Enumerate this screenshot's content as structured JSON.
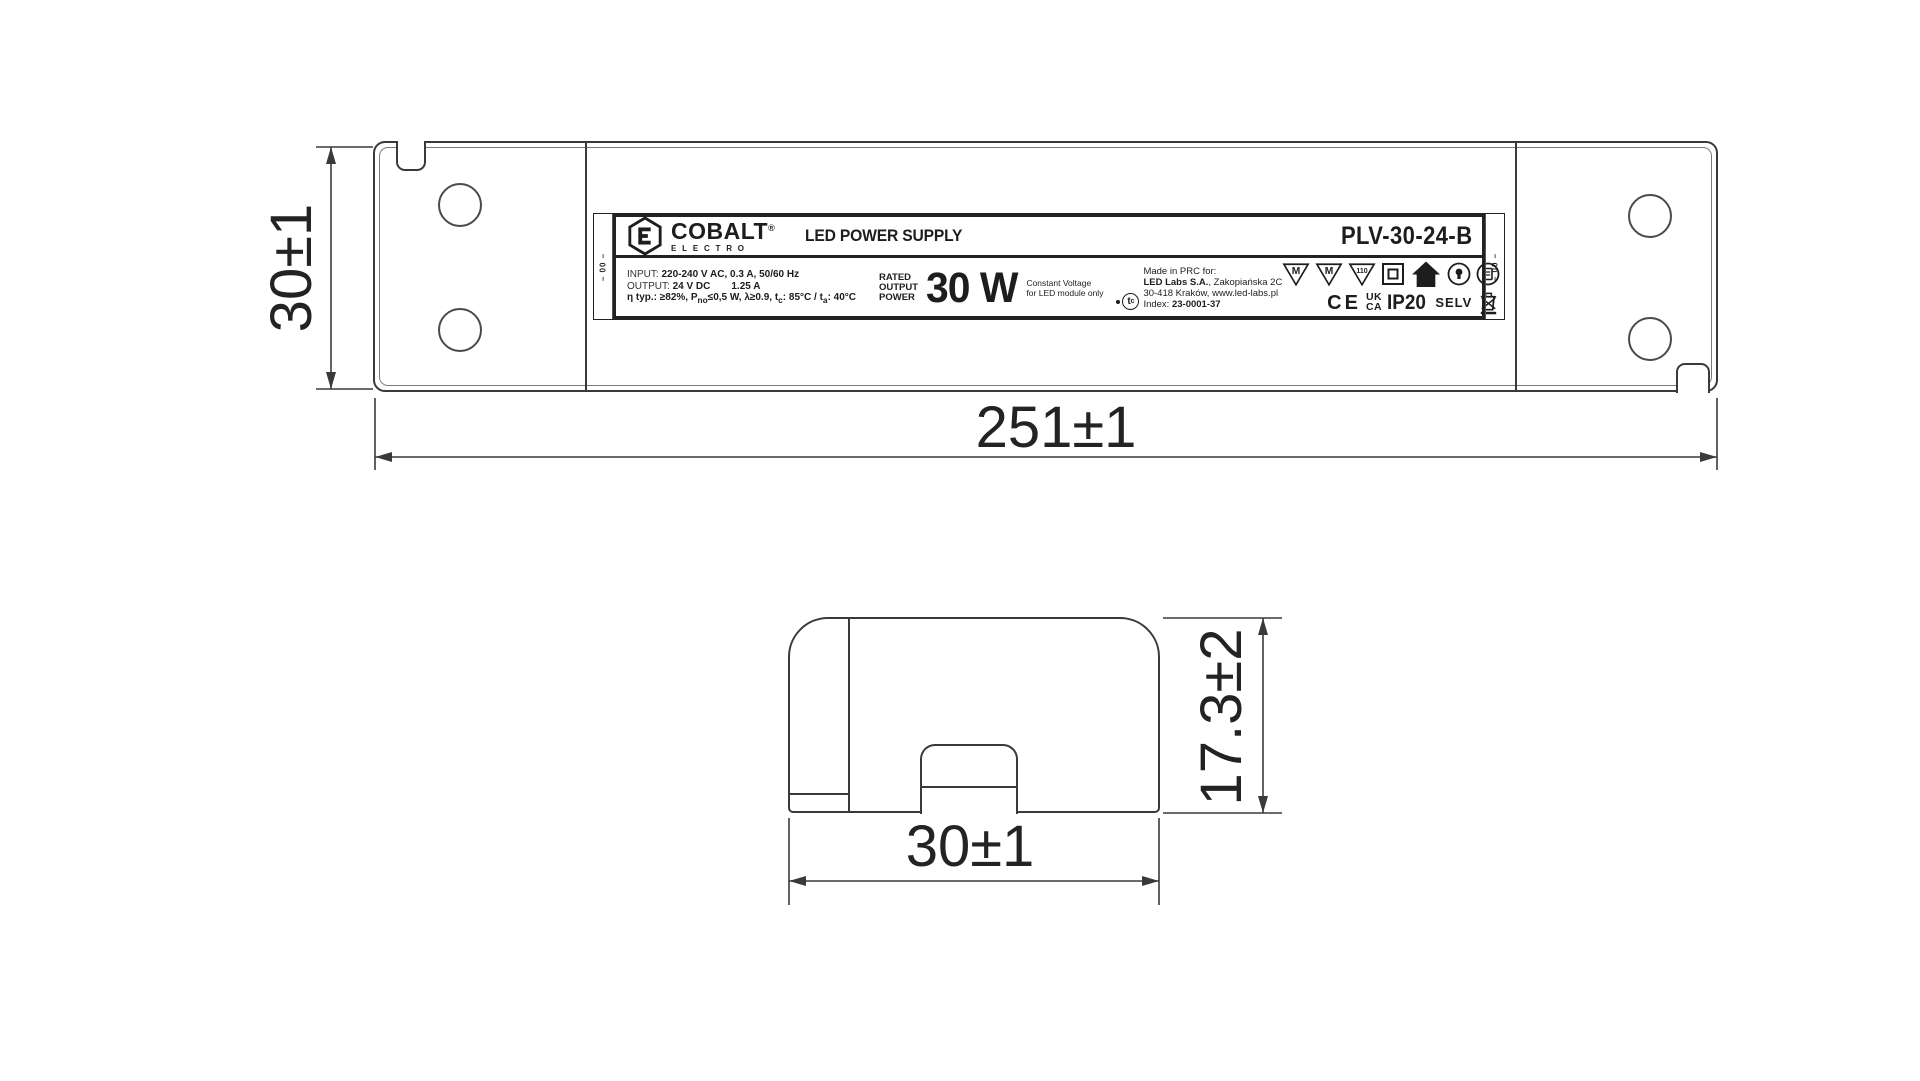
{
  "page": {
    "background": "#ffffff",
    "ink": "#1d1d1d",
    "line_color": "#3a3a3a"
  },
  "dims": {
    "top_view_height": "30±1",
    "top_view_length": "251±1",
    "end_view_width": "30±1",
    "end_view_height": "17.3±2"
  },
  "label": {
    "strip_code": "– 00 –",
    "brand": {
      "name": "COBALT",
      "reg": "®",
      "sub": "ELECTRO"
    },
    "product": {
      "bold": "LED",
      "rest": " POWER SUPPLY"
    },
    "model": "PLV-30-24-B",
    "specs": {
      "input_label": "INPUT:",
      "input_value": "220-240 V AC, 0.3 A, 50/60 Hz",
      "output_label": "OUTPUT:",
      "output_voltage": "24 V DC",
      "output_current": "1.25 A",
      "eta_1": "η typ.: ≥82%, P",
      "eta_sub1": "no",
      "eta_2": "≤0,5 W, λ≥0.9, t",
      "eta_sub2": "c",
      "eta_3": ": 85°C / t",
      "eta_sub3": "a",
      "eta_4": ": 40°C"
    },
    "rated": {
      "w1": "RATED",
      "w2": "OUTPUT",
      "w3": "POWER",
      "value": "30 W",
      "note1": "Constant Voltage",
      "note2": "for LED module only"
    },
    "made": {
      "l1": "Made in PRC for:",
      "l2_bold": "LED Labs S.A.",
      "l2_rest": ", Zakopiańska 2C",
      "l3": "30-418 Kraków, www.led-labs.pl",
      "l4_label": "Index: ",
      "l4_value": "23-0001-37",
      "tc": "t",
      "tc_sub": "c"
    },
    "marks": {
      "m1": "M",
      "m2": "M",
      "t110": "110",
      "ce": "CE",
      "uk": "UK",
      "ca": "CA",
      "ip": "IP20",
      "selv": "SELV"
    }
  }
}
